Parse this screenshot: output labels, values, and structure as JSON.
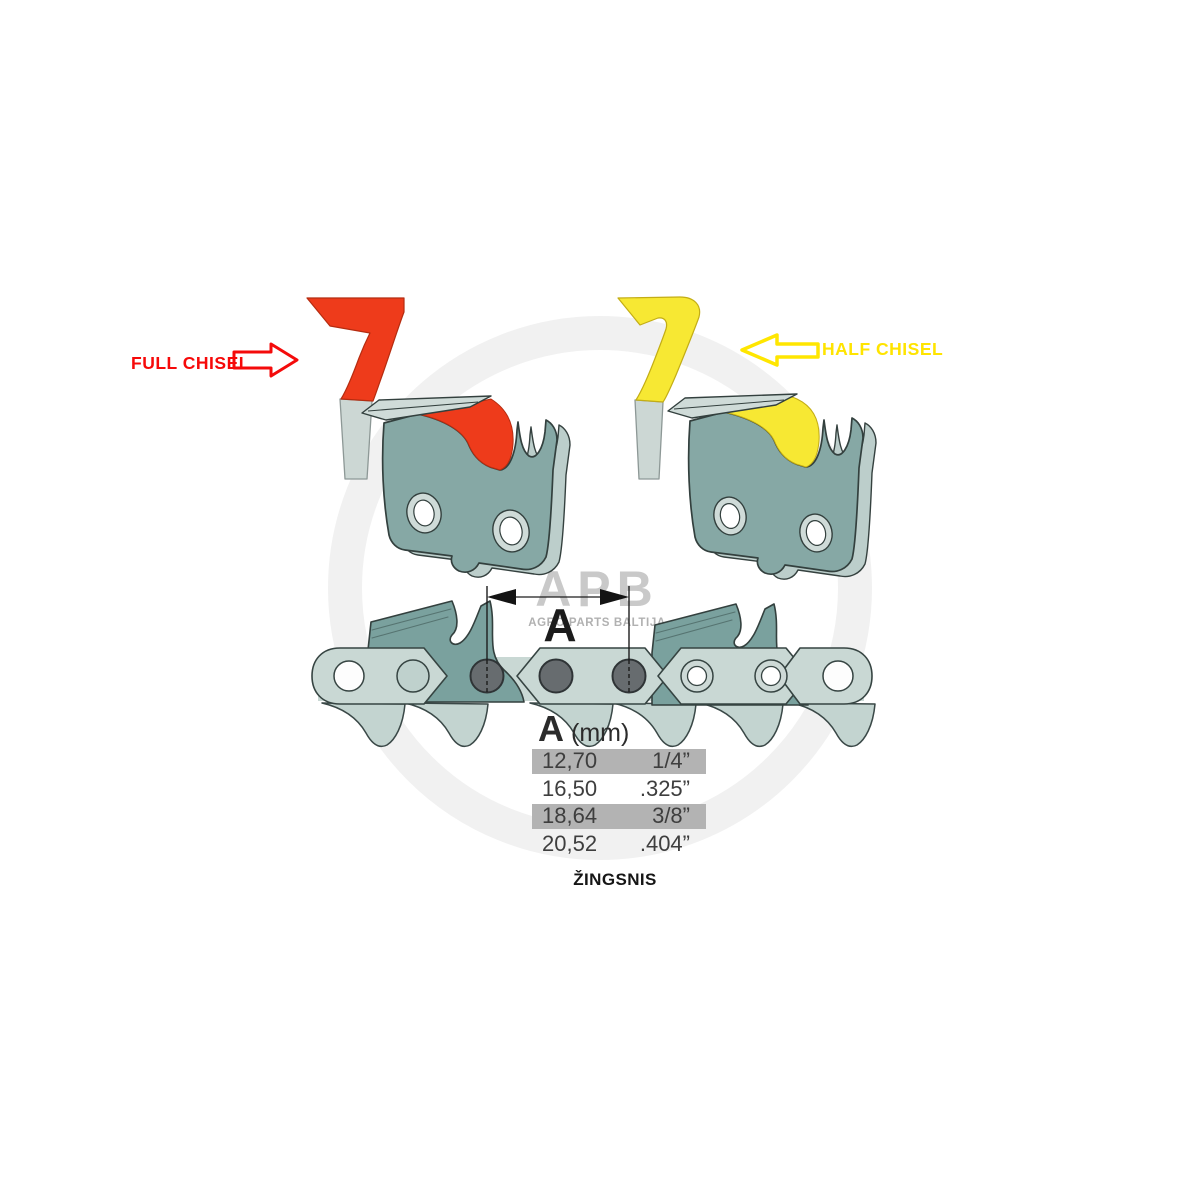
{
  "annotations": {
    "full_chisel": {
      "label": "FULL CHISEL",
      "color": "#f60909"
    },
    "half_chisel": {
      "label": "HALF CHISEL",
      "color": "#ffe400"
    }
  },
  "dimension": {
    "label": "A"
  },
  "pitch_table": {
    "header": {
      "letter": "A",
      "unit": "(mm)"
    },
    "rows": [
      {
        "mm": "12,70",
        "inches": "1/4”",
        "highlighted": true
      },
      {
        "mm": "16,50",
        "inches": ".325”",
        "highlighted": false
      },
      {
        "mm": "18,64",
        "inches": "3/8”",
        "highlighted": true
      },
      {
        "mm": "20,52",
        "inches": ".404”",
        "highlighted": false
      }
    ],
    "caption": "ŽINGSNIS",
    "highlight_color": "#b3b3b3"
  },
  "watermark": {
    "brand": "APB",
    "subtitle": "AGRO PARTS BALTIJA"
  },
  "colors": {
    "full_chisel_accent": "#ee3b1b",
    "half_chisel_accent": "#f7e833",
    "cutter_body": "#86a8a5",
    "cutter_light": "#cfdbd8",
    "chain_strap": "#c9d8d4",
    "rivet_dark": "#676c6f",
    "table_highlight": "#b3b3b3"
  }
}
